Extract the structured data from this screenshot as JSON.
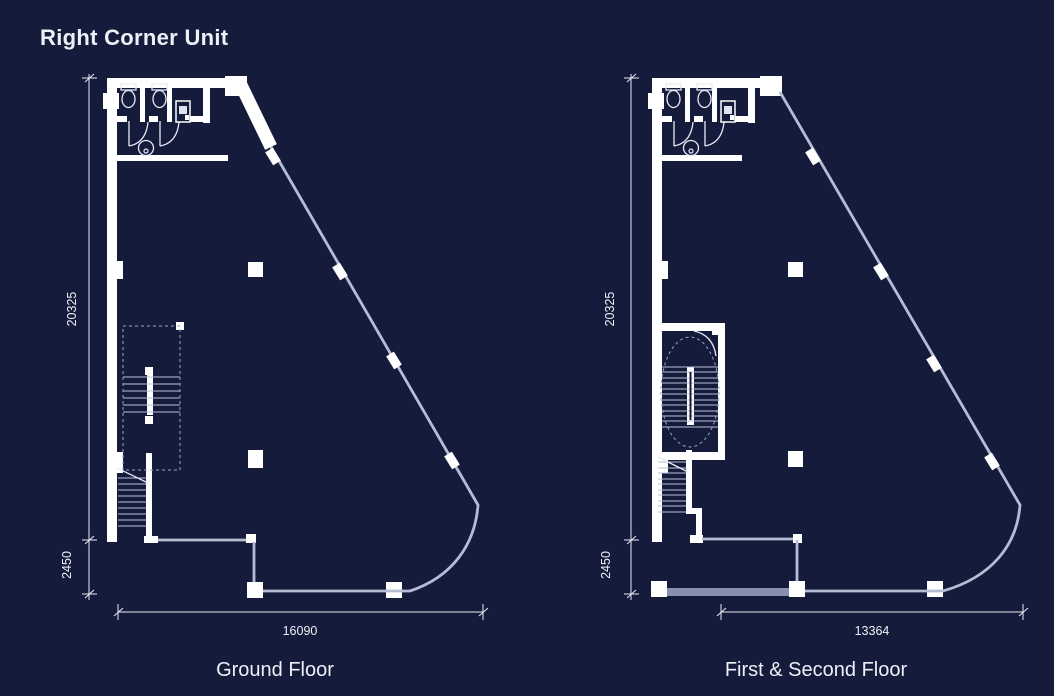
{
  "title": "Right Corner Unit",
  "colors": {
    "background": "#151b3a",
    "wall": "#ffffff",
    "glazing": "#b6bcd4",
    "dashed_line": "#9aa3c4",
    "grey_wall": "#8a90ab",
    "dimension_line": "#e9ebf4",
    "text": "#eef0f8"
  },
  "plans": [
    {
      "label": "Ground Floor",
      "dimensions": {
        "depth": "20325",
        "front_setback": "2450",
        "frontage": "16090"
      }
    },
    {
      "label": "First & Second Floor",
      "dimensions": {
        "depth": "20325",
        "front_setback": "2450",
        "frontage": "13364"
      }
    }
  ]
}
